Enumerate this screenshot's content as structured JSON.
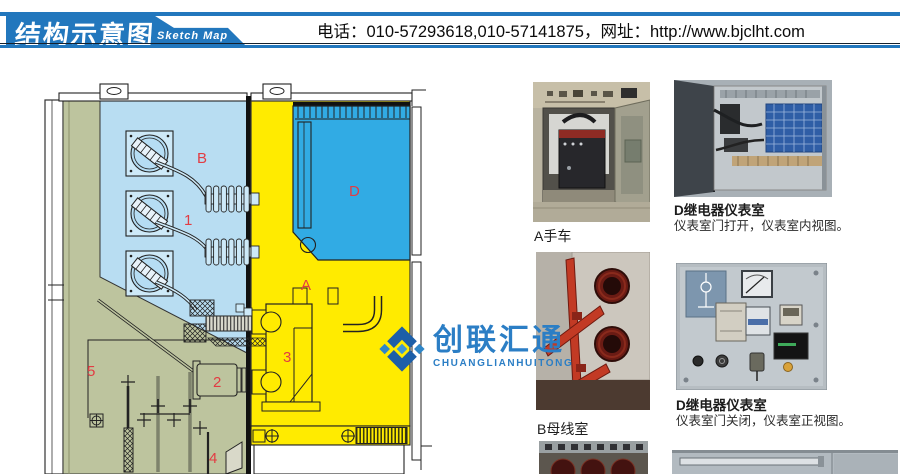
{
  "header": {
    "page_title": "结构示意图",
    "page_title_en": "Sketch Map",
    "contact_line": "电话：010-57293618,010-57141875，网址：http://www.bjclht.com"
  },
  "watermark": {
    "brand_cn": "创联汇通",
    "brand_en": "CHUANGLIANHUITONG"
  },
  "diagram": {
    "type": "switchgear-cross-section-sketch",
    "compartment_labels": [
      {
        "text": "B",
        "x": 197,
        "y": 151
      },
      {
        "text": "1",
        "x": 184,
        "y": 213
      },
      {
        "text": "D",
        "x": 349,
        "y": 184
      },
      {
        "text": "A",
        "x": 301,
        "y": 278
      },
      {
        "text": "3",
        "x": 283,
        "y": 350
      },
      {
        "text": "2",
        "x": 213,
        "y": 375
      },
      {
        "text": "5",
        "x": 87,
        "y": 364
      },
      {
        "text": "4",
        "x": 209,
        "y": 451
      }
    ],
    "label_color": "#e23c43"
  },
  "photos": [
    {
      "id": "photo-a-handcart",
      "caption": "A手车",
      "subcaption": ""
    },
    {
      "id": "photo-d-open",
      "caption": "D继电器仪表室",
      "subcaption": "仪表室门打开，仪表室内视图。"
    },
    {
      "id": "photo-b-busbar",
      "caption": "B母线室",
      "subcaption": ""
    },
    {
      "id": "photo-d-closed",
      "caption": "D继电器仪表室",
      "subcaption": "仪表室门关闭，仪表室正视图。"
    }
  ],
  "colors": {
    "header_blue": "#2277bd",
    "busbar_room_blue": "#b8ddf2",
    "instrument_room_blue": "#31abe4",
    "breaker_room_yellow": "#ffeb00",
    "cable_room_olive": "#bdc49e",
    "label_red": "#e23c43",
    "brand_blue": "#2b7ec5"
  }
}
